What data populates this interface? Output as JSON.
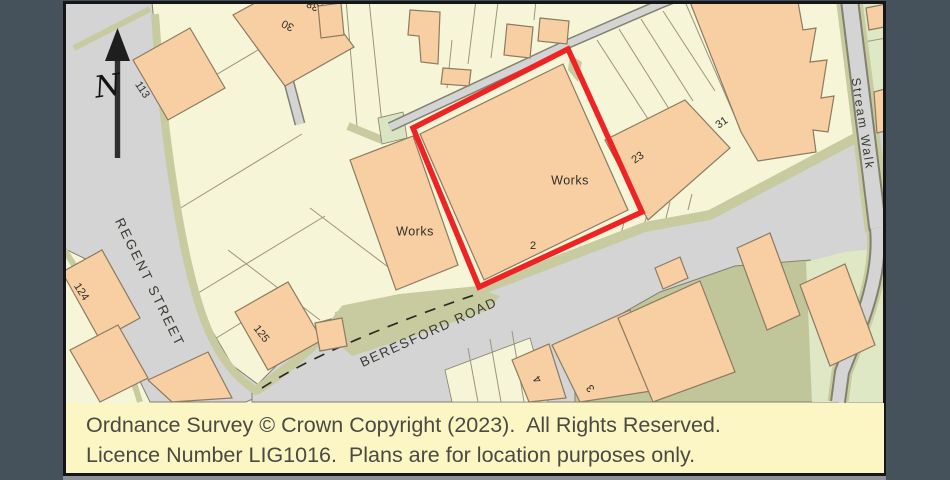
{
  "page": {
    "background_color": "#46525B"
  },
  "map": {
    "north_label": "N",
    "streets": {
      "regent_street": "REGENT STREET",
      "beresford_road": "BERESFORD ROAD",
      "stream_walk": "Stream Walk"
    },
    "site": {
      "label": "Works",
      "number": "2",
      "boundary_color": "#EE2424"
    },
    "labels": {
      "works_left": "Works",
      "n113": "113",
      "n124": "124",
      "n125": "125",
      "n30": "30",
      "n38": "38",
      "n23": "23",
      "n31": "31",
      "n4": "4",
      "n3": "3"
    },
    "colors": {
      "building": "#F8CEA3",
      "plot": "#F7F5D7",
      "road": "#D4D4D5",
      "verge": "#C8CBA0",
      "green_space": "#DFE8C5",
      "dark_green": "#C1C69A",
      "outline": "#8B7B60",
      "boundary_red": "#EE2424"
    }
  },
  "footer": {
    "background_color": "#FBF6C4",
    "line1": "Ordnance Survey © Crown Copyright (2023).  All Rights Reserved.",
    "line2": "Licence Number LIG1016.  Plans are for location purposes only."
  }
}
